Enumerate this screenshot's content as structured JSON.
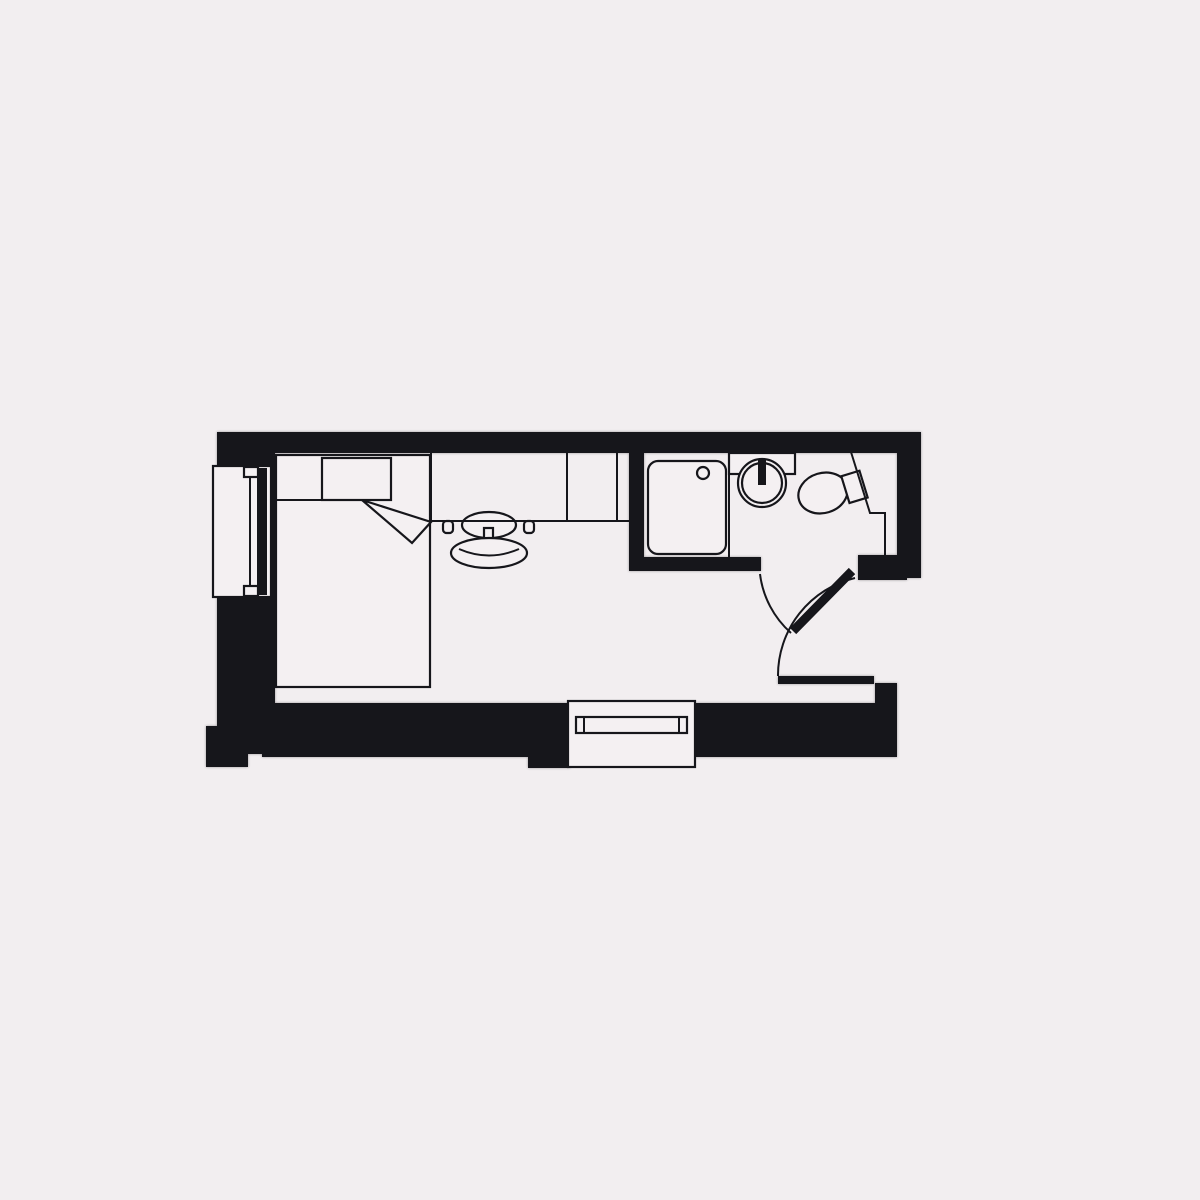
{
  "title": "studio-room-floor-plan",
  "colors": {
    "background": "#f2eef0",
    "ink": "#16161b",
    "fixture_fill": "#f4f0f2"
  },
  "floor_plan": {
    "type": "architectural-plan",
    "rooms": [
      {
        "name": "main-room",
        "contents": [
          "bed",
          "pillow",
          "blanket-fold",
          "desk",
          "desk-chair",
          "left-window-unit",
          "bottom-window"
        ]
      },
      {
        "name": "bathroom",
        "contents": [
          "shower-tray",
          "shower-drain",
          "washbasin",
          "faucet",
          "sink-counter",
          "toilet"
        ]
      }
    ],
    "openings": [
      {
        "name": "bathroom-door",
        "style": "swing-with-arc"
      },
      {
        "name": "entry-door",
        "style": "swing-with-arc"
      },
      {
        "name": "window-left-wall",
        "style": "glazed"
      },
      {
        "name": "window-bottom-wall",
        "style": "glazed"
      }
    ],
    "text_labels": []
  }
}
